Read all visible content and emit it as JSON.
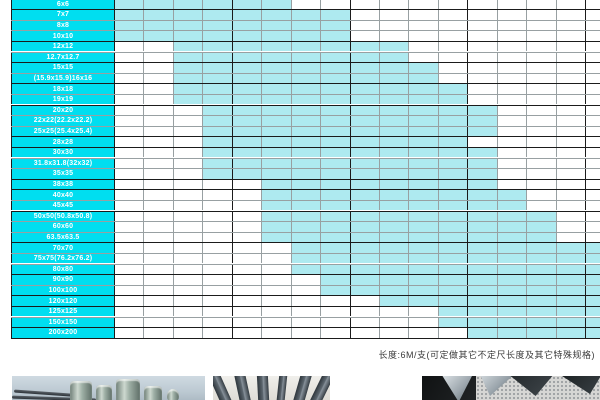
{
  "table": {
    "description": "square steel size vs wall-thickness availability matrix",
    "columns_visible": 17,
    "colors": {
      "label_bg": "#00def0",
      "cell_fill": "#aeeaf0",
      "grid_line": "#98a0a2",
      "grid_thick": "#1b1b1b"
    },
    "rows": [
      {
        "label": "6x6",
        "start": 1,
        "end": 6
      },
      {
        "label": "7x7",
        "start": 1,
        "end": 8
      },
      {
        "label": "8x8",
        "start": 1,
        "end": 8
      },
      {
        "label": "10x10",
        "start": 1,
        "end": 8
      },
      {
        "label": "12x12",
        "start": 3,
        "end": 10
      },
      {
        "label": "12.7x12.7",
        "start": 3,
        "end": 10
      },
      {
        "label": "15x15",
        "start": 3,
        "end": 11
      },
      {
        "label": "(15.9x15.9)16x16",
        "start": 3,
        "end": 11
      },
      {
        "label": "18x18",
        "start": 3,
        "end": 12
      },
      {
        "label": "19x19",
        "start": 3,
        "end": 12
      },
      {
        "label": "20x20",
        "start": 4,
        "end": 13
      },
      {
        "label": "22x22(22.2x22.2)",
        "start": 4,
        "end": 13
      },
      {
        "label": "25x25(25.4x25.4)",
        "start": 4,
        "end": 13
      },
      {
        "label": "28x28",
        "start": 4,
        "end": 12
      },
      {
        "label": "30x30",
        "start": 4,
        "end": 13
      },
      {
        "label": "31.8x31.8(32x32)",
        "start": 4,
        "end": 13
      },
      {
        "label": "35x35",
        "start": 4,
        "end": 13
      },
      {
        "label": "38x38",
        "start": 6,
        "end": 13
      },
      {
        "label": "40x40",
        "start": 6,
        "end": 14
      },
      {
        "label": "45x45",
        "start": 6,
        "end": 14
      },
      {
        "label": "50x50(50.8x50.8)",
        "start": 6,
        "end": 15
      },
      {
        "label": "60x60",
        "start": 6,
        "end": 15
      },
      {
        "label": "63.5x63.5",
        "start": 6,
        "end": 15
      },
      {
        "label": "70x70",
        "start": 7,
        "end": 17
      },
      {
        "label": "75x75(76.2x76.2)",
        "start": 7,
        "end": 17
      },
      {
        "label": "80x80",
        "start": 7,
        "end": 17
      },
      {
        "label": "90x90",
        "start": 8,
        "end": 17
      },
      {
        "label": "100x100",
        "start": 8,
        "end": 17
      },
      {
        "label": "120x120",
        "start": 10,
        "end": 17
      },
      {
        "label": "125x125",
        "start": 12,
        "end": 17
      },
      {
        "label": "150x150",
        "start": 12,
        "end": 17
      },
      {
        "label": "200x200",
        "start": 13,
        "end": 17
      }
    ]
  },
  "footnote": "长度:6M/支(可定做其它不定尺长度及其它特殊规格)",
  "photos": [
    {
      "name": "photo-steel-billets",
      "depicts": "round steel billets and bars on light background"
    },
    {
      "name": "photo-flat-bars",
      "depicts": "dark flat steel bars fanned upright"
    },
    {
      "name": "photo-angle-steel",
      "depicts": "angle steel profiles on dark background with halftone texture"
    }
  ]
}
